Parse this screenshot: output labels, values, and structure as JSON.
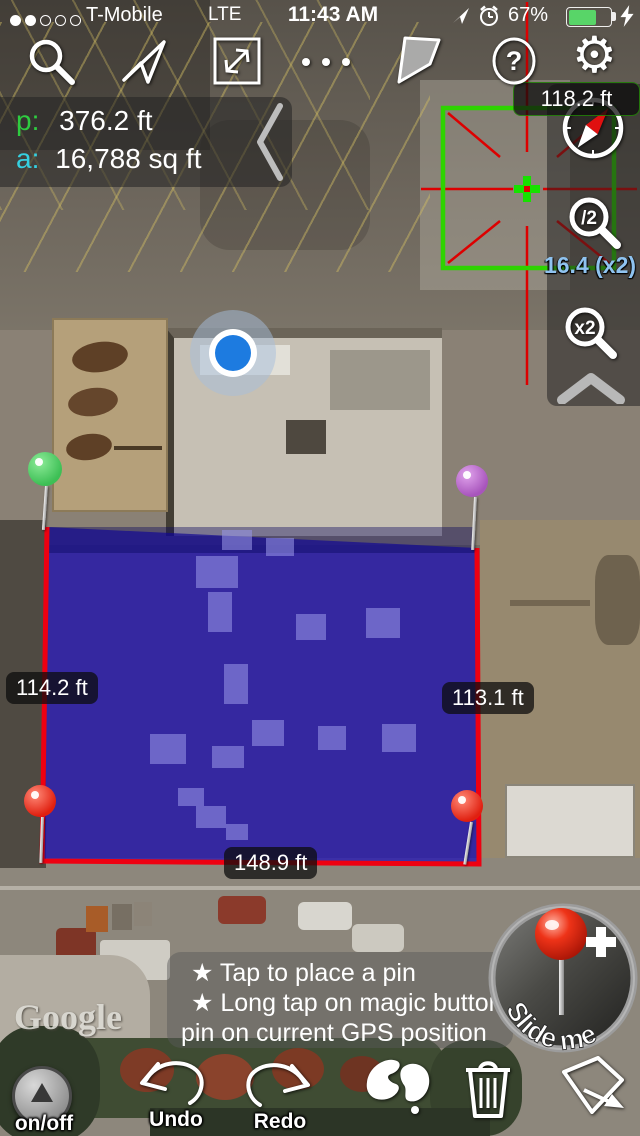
{
  "status_bar": {
    "carrier": "T-Mobile",
    "network": "LTE",
    "time": "11:43 AM",
    "battery_percent": "67%",
    "signal_filled_dots": 2,
    "signal_total_dots": 5
  },
  "toolbar": {
    "help_glyph": "?",
    "gear_glyph": "⚙"
  },
  "measure_panel": {
    "p_label": "p:",
    "p_value": "376.2 ft",
    "a_label": "a:",
    "a_value": "16,788 sq ft"
  },
  "loupe": {
    "length_label": "118.2 ft",
    "scale_label": "16.4 (x2)"
  },
  "zoom_controls": {
    "out_label": "/2",
    "in_label": "x2"
  },
  "edge_labels": {
    "left": "114.2 ft",
    "right": "113.1 ft",
    "bottom": "148.9 ft"
  },
  "hint_box": {
    "line1": "★ Tap to place a pin",
    "line2": "★ Long tap on magic button:",
    "line3": "pin on current GPS position"
  },
  "magic_button": {
    "label": "Slide me",
    "plus": "+"
  },
  "bottom_bar": {
    "onoff": "on/off",
    "undo": "Undo",
    "redo": "Redo"
  },
  "watermark": {
    "text": "Google"
  },
  "colors": {
    "polygon_fill": "#1a0ab9",
    "polygon_edge": "#ee0011",
    "loupe_green": "#2ed300",
    "crosshair_red": "#dd0000",
    "scale_text": "#8fc3f0",
    "p_color": "#2ecc40",
    "a_color": "#35d0e0",
    "battery_green": "#58d568",
    "pin_green": "#4ecf63",
    "pin_purple": "#c06fd4",
    "pin_red": "#f03522"
  }
}
